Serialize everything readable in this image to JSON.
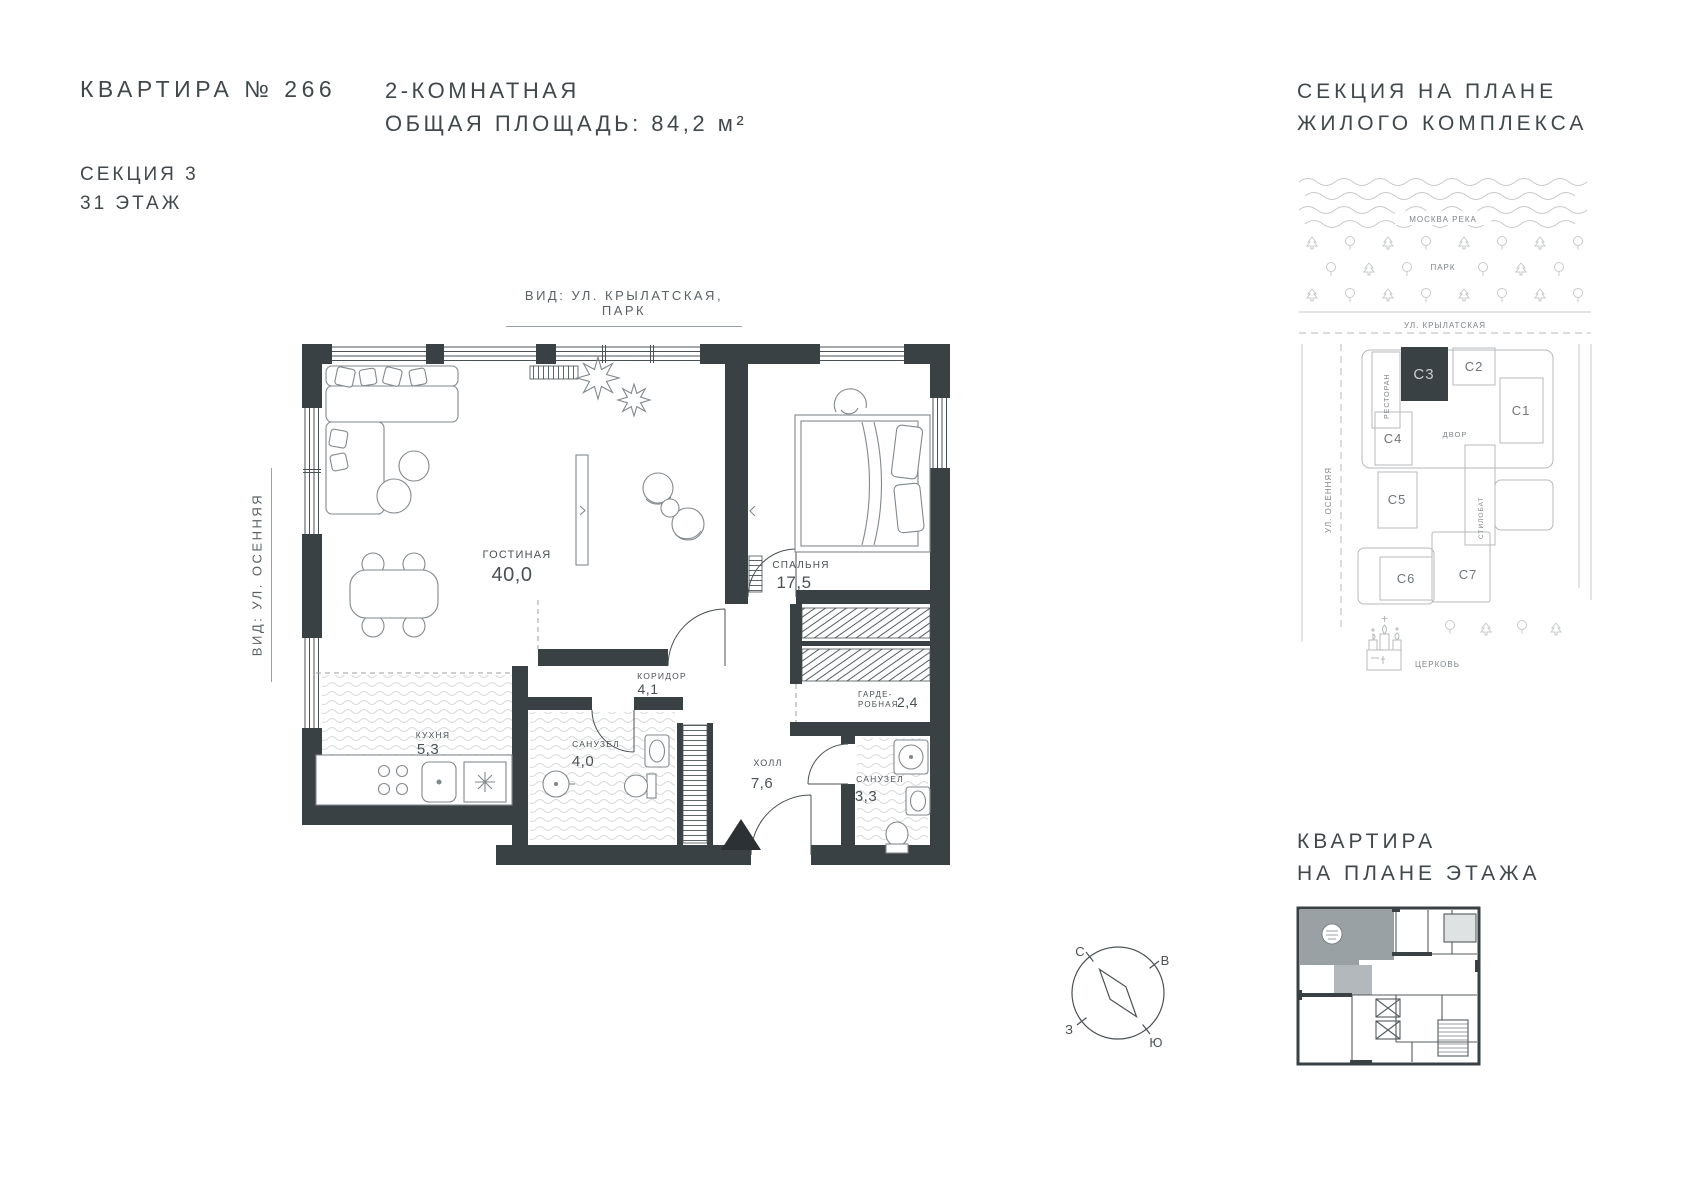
{
  "header": {
    "apartment": "КВАРТИРА № 266",
    "section": "СЕКЦИЯ 3",
    "floor": "31 ЭТАЖ",
    "type": "2-КОМНАТНАЯ",
    "area": "ОБЩАЯ ПЛОЩАДЬ: 84,2 м²"
  },
  "site_plan": {
    "title1": "СЕКЦИЯ НА ПЛАНЕ",
    "title2": "ЖИЛОГО КОМПЛЕКСА",
    "river": "МОСКВА РЕКА",
    "park": "ПАРК",
    "street_top": "УЛ. КРЫЛАТСКАЯ",
    "street_left": "УЛ. ОСЕННЯЯ",
    "restaurant": "РЕСТОРАН",
    "courtyard": "ДВОР",
    "stylobate": "СТИЛОБАТ",
    "church": "ЦЕРКОВЬ",
    "sections": {
      "c1": "С1",
      "c2": "С2",
      "c3": "С3",
      "c4": "С4",
      "c5": "С5",
      "c6": "С6",
      "c7": "С7"
    },
    "highlighted_section": "С3"
  },
  "floor_plan": {
    "view_top": "ВИД: УЛ. КРЫЛАТСКАЯ, ПАРК",
    "view_left": "ВИД: УЛ. ОСЕННЯЯ",
    "rooms": {
      "living": {
        "name": "ГОСТИНАЯ",
        "area": "40,0"
      },
      "bedroom": {
        "name": "СПАЛЬНЯ",
        "area": "17,5"
      },
      "corridor": {
        "name": "КОРИДОР",
        "area": "4,1"
      },
      "kitchen": {
        "name": "КУХНЯ",
        "area": "5,3"
      },
      "bath1": {
        "name": "САНУЗЕЛ",
        "area": "4,0"
      },
      "hall": {
        "name": "ХОЛЛ",
        "area": "7,6"
      },
      "wardrobe": {
        "line1": "ГАРДЕ-",
        "line2": "РОБНАЯ",
        "area": "2,4"
      },
      "bath2": {
        "name": "САНУЗЕЛ",
        "area": "3,3"
      }
    }
  },
  "compass": {
    "north": "С",
    "east": "В",
    "west": "З",
    "south": "Ю"
  },
  "mini_plan": {
    "title1": "КВАРТИРА",
    "title2": "НА ПЛАНЕ ЭТАЖА"
  },
  "colors": {
    "wall": "#3a4144",
    "text": "#41484c",
    "muted": "#7d8488",
    "line": "#c6cacc",
    "highlight": "#9aa1a5"
  }
}
